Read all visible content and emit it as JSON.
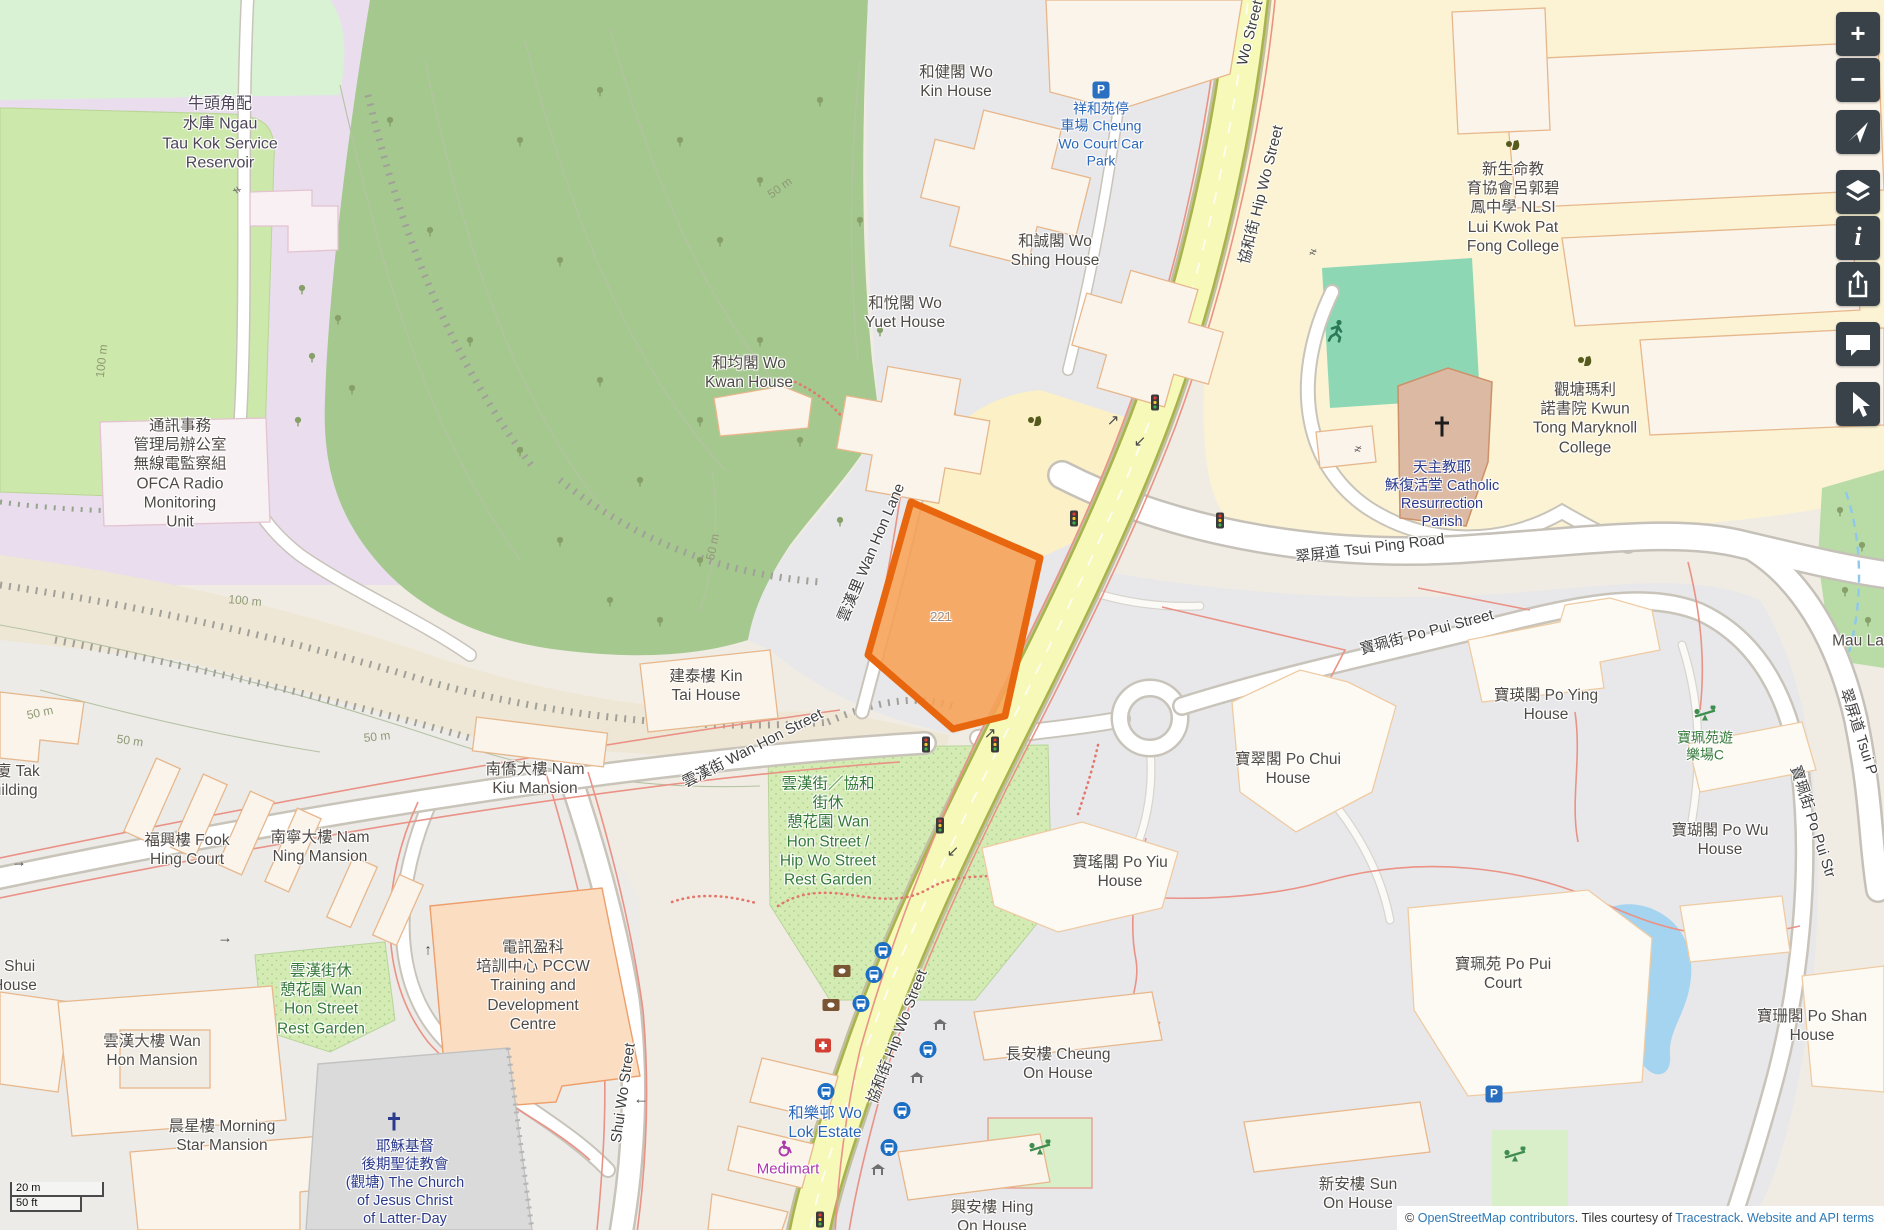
{
  "colors": {
    "highlight_fill": "#f7a055",
    "highlight_border": "#e8660e",
    "road_primary_fill": "#f6f9b7",
    "park_green": "#d4ecb4",
    "forest_green": "#a5c88f",
    "water_blue": "#a5d4f0",
    "control_bg": "#394249",
    "link_blue": "#2d78b5"
  },
  "labels": {
    "reservoir": "牛頭角配\n水庫 Ngau\nTau Kok Service\nReservoir",
    "ofca": "通訊事務\n管理局辦公室\n無線電監察組\nOFCA Radio\nMonitoring\nUnit",
    "woKin": "和健閣 Wo\nKin House",
    "carpark": "祥和苑停\n車場 Cheung\nWo Court Car\nPark",
    "woShing": "和誠閣 Wo\nShing House",
    "woYuet": "和悅閣 Wo\nYuet House",
    "woKwan": "和均閣 Wo\nKwan House",
    "nlsi": "新生命教\n育協會呂郭碧\n鳳中學 NLSI\nLui Kwok Pat\nFong College",
    "maryknoll": "觀塘瑪利\n諾書院 Kwun\nTong Maryknoll\nCollege",
    "parish": "天主教耶\n穌復活堂 Catholic\nResurrection\nParish",
    "kinTai": "建泰樓 Kin\nTai House",
    "namKiu": "南僑大樓 Nam\nKiu Mansion",
    "fookHing": "福興樓 Fook\nHing Court",
    "namNing": "南寧大樓 Nam\nNing Mansion",
    "tak": "大廈 Tak\nBuilding",
    "shuiNing": "寧樓 Shui\ning House",
    "wanHonMansion": "雲漢大樓 Wan\nHon Mansion",
    "morningStar": "晨星樓 Morning\nStar Mansion",
    "pccw": "電訊盈科\n培訓中心 PCCW\nTraining and\nDevelopment\nCentre",
    "lds": "耶穌基督\n後期聖徒教會\n(觀塘) The Church\nof Jesus Christ\nof Latter-Day",
    "restGardenSmall": "雲漢街休\n憩花園 Wan\nHon Street\nRest Garden",
    "restGardenMain": "雲漢街／協和\n街休\n憩花園 Wan\nHon Street /\nHip Wo Street\nRest Garden",
    "woLok": "和樂邨 Wo\nLok Estate",
    "medimart": "Medimart",
    "poYiu": "寶瑤閣 Po Yiu\nHouse",
    "poChui": "寶翠閣 Po Chui\nHouse",
    "poWu": "寶瑚閣 Po Wu\nHouse",
    "poYing": "寶瑛閣 Po Ying\nHouse",
    "playgroundC": "寶珮苑遊\n樂場C",
    "poPuiCourt": "寶珮苑 Po Pui\nCourt",
    "poShan": "寶珊閣 Po Shan\nHouse",
    "cheungOn": "長安樓 Cheung\nOn House",
    "sunOn": "新安樓 Sun\nOn House",
    "hingOn": "興安樓 Hing\nOn House",
    "plot221": "221",
    "mauLa": "Mau La"
  },
  "streets": {
    "hipWo": "協和街 Hip Wo Street",
    "woStreetTop": "Wo Street",
    "wanHonStreet": "雲漢街 Wan Hon Street",
    "wanHonLane": "雲漢里 Wan Hon Lane",
    "tsuiPing": "翠屏道 Tsui Ping Road",
    "tsuiPingRight": "翠屏道 Tsui P",
    "poPuiStreet": "寶珮街 Po Pui Street",
    "poPuiRight": "寶珮街 Po Pui Str",
    "shuiWo": "Shui Wo Street"
  },
  "contours": {
    "k1": "100 m",
    "k2": "100 m",
    "k3": "50 m",
    "k4": "50 m",
    "k5": "50 m",
    "k6": "50 m",
    "k7": "50 m"
  },
  "road_arrows": {
    "a1": "↗",
    "a2": "↙",
    "a3": "↗",
    "a4": "↙",
    "a5": "←",
    "a6": "→",
    "a7": "→",
    "a8": "↑"
  },
  "gates": {
    "g1": "≠",
    "g2": "≠",
    "g3": "≠"
  },
  "icons": {
    "parking_glyph": "P"
  },
  "controls": {
    "zoom_in": "+",
    "zoom_out": "−",
    "info_glyph": "i"
  },
  "scalebar": {
    "metric": "20 m",
    "imperial": "50 ft"
  },
  "attribution": {
    "copyright": "©",
    "osm_link": "OpenStreetMap contributors",
    "middle": ". Tiles courtesy of ",
    "tracestrack_link": "Tracestrack",
    "sep": ". ",
    "terms_link": "Website and API terms"
  }
}
